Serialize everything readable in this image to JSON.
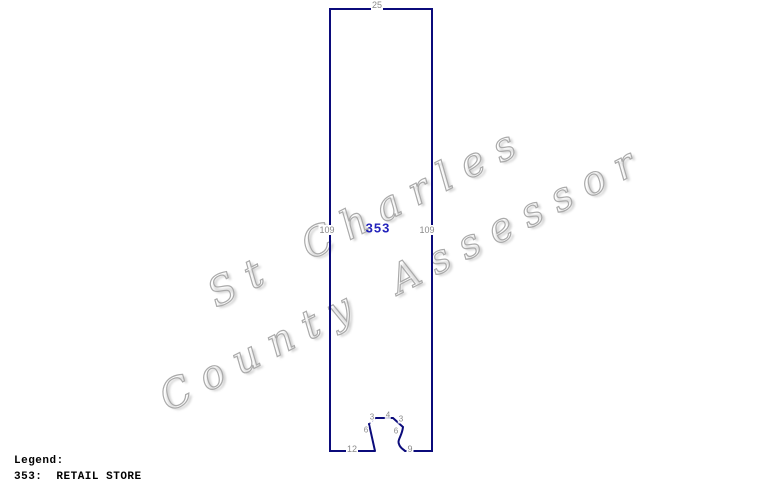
{
  "watermark": {
    "line1": "St Charles",
    "line2": "County Assessor"
  },
  "sketch": {
    "area_code": "353",
    "dims": {
      "top": "25",
      "side_left": "109",
      "side_right": "109",
      "bottom_left": "12",
      "bottom_right": "9",
      "notch_left_diag": "6",
      "notch_left_top": "3",
      "notch_top": "4",
      "notch_right_diag": "3",
      "notch_right_side": "6"
    }
  },
  "legend": {
    "title": "Legend:",
    "entries": [
      {
        "code": "353:",
        "label": "RETAIL STORE"
      }
    ]
  },
  "colors": {
    "outline": "#0b0b7b",
    "area_label": "#2323bb",
    "dim_label": "#8a8a8a",
    "watermark": "#aaaaaa"
  }
}
